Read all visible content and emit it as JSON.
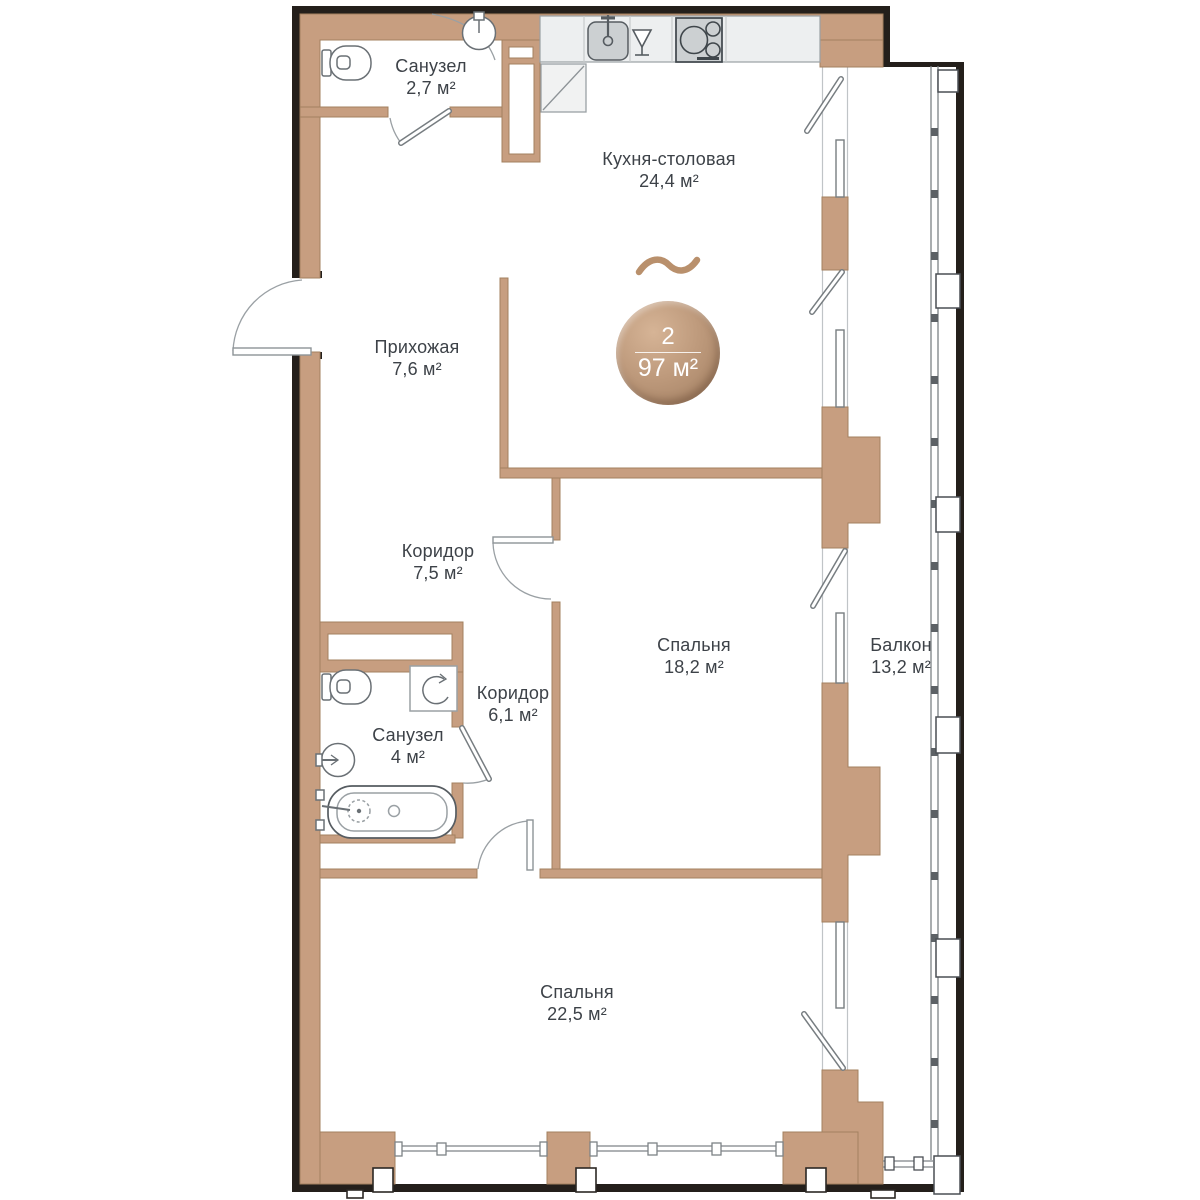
{
  "floorplan": {
    "type_label": "apartment-floor-plan",
    "badge": {
      "rooms_count": "2",
      "total_area": "97 м²"
    },
    "rooms": [
      {
        "id": "bathroom-top",
        "name": "Санузел",
        "area": "2,7 м²"
      },
      {
        "id": "kitchen",
        "name": "Кухня-столовая",
        "area": "24,4 м²"
      },
      {
        "id": "hallway",
        "name": "Прихожая",
        "area": "7,6 м²"
      },
      {
        "id": "corridor-main",
        "name": "Коридор",
        "area": "7,5 м²"
      },
      {
        "id": "bedroom-1",
        "name": "Спальня",
        "area": "18,2 м²"
      },
      {
        "id": "corridor-2",
        "name": "Коридор",
        "area": "6,1 м²"
      },
      {
        "id": "bathroom-main",
        "name": "Санузел",
        "area": "4 м²"
      },
      {
        "id": "balcony",
        "name": "Балкон",
        "area": "13,2 м²"
      },
      {
        "id": "bedroom-2",
        "name": "Спальня",
        "area": "22,5 м²"
      }
    ],
    "icons": {
      "wave": "tilde-wave",
      "kitchen": [
        "kitchen-sink",
        "wine-glass-dishwasher",
        "stove-cooktop",
        "fridge"
      ],
      "bathroom_top": [
        "toilet",
        "washbasin"
      ],
      "bathroom_main": [
        "toilet",
        "shower-arrow",
        "washbasin",
        "bathtub"
      ]
    },
    "colors": {
      "wall_fill": "#c79e80",
      "wall_edge": "#a3805f",
      "outer_line": "#241f1b",
      "fixture_stroke": "#6a7075",
      "appliance_fill": "#ccd0d2",
      "counter_fill": "#edeff0",
      "text": "#3d4248",
      "badge_light": "#d6b496",
      "badge_dark": "#9e7c5f",
      "wave": "#b9906c"
    }
  }
}
